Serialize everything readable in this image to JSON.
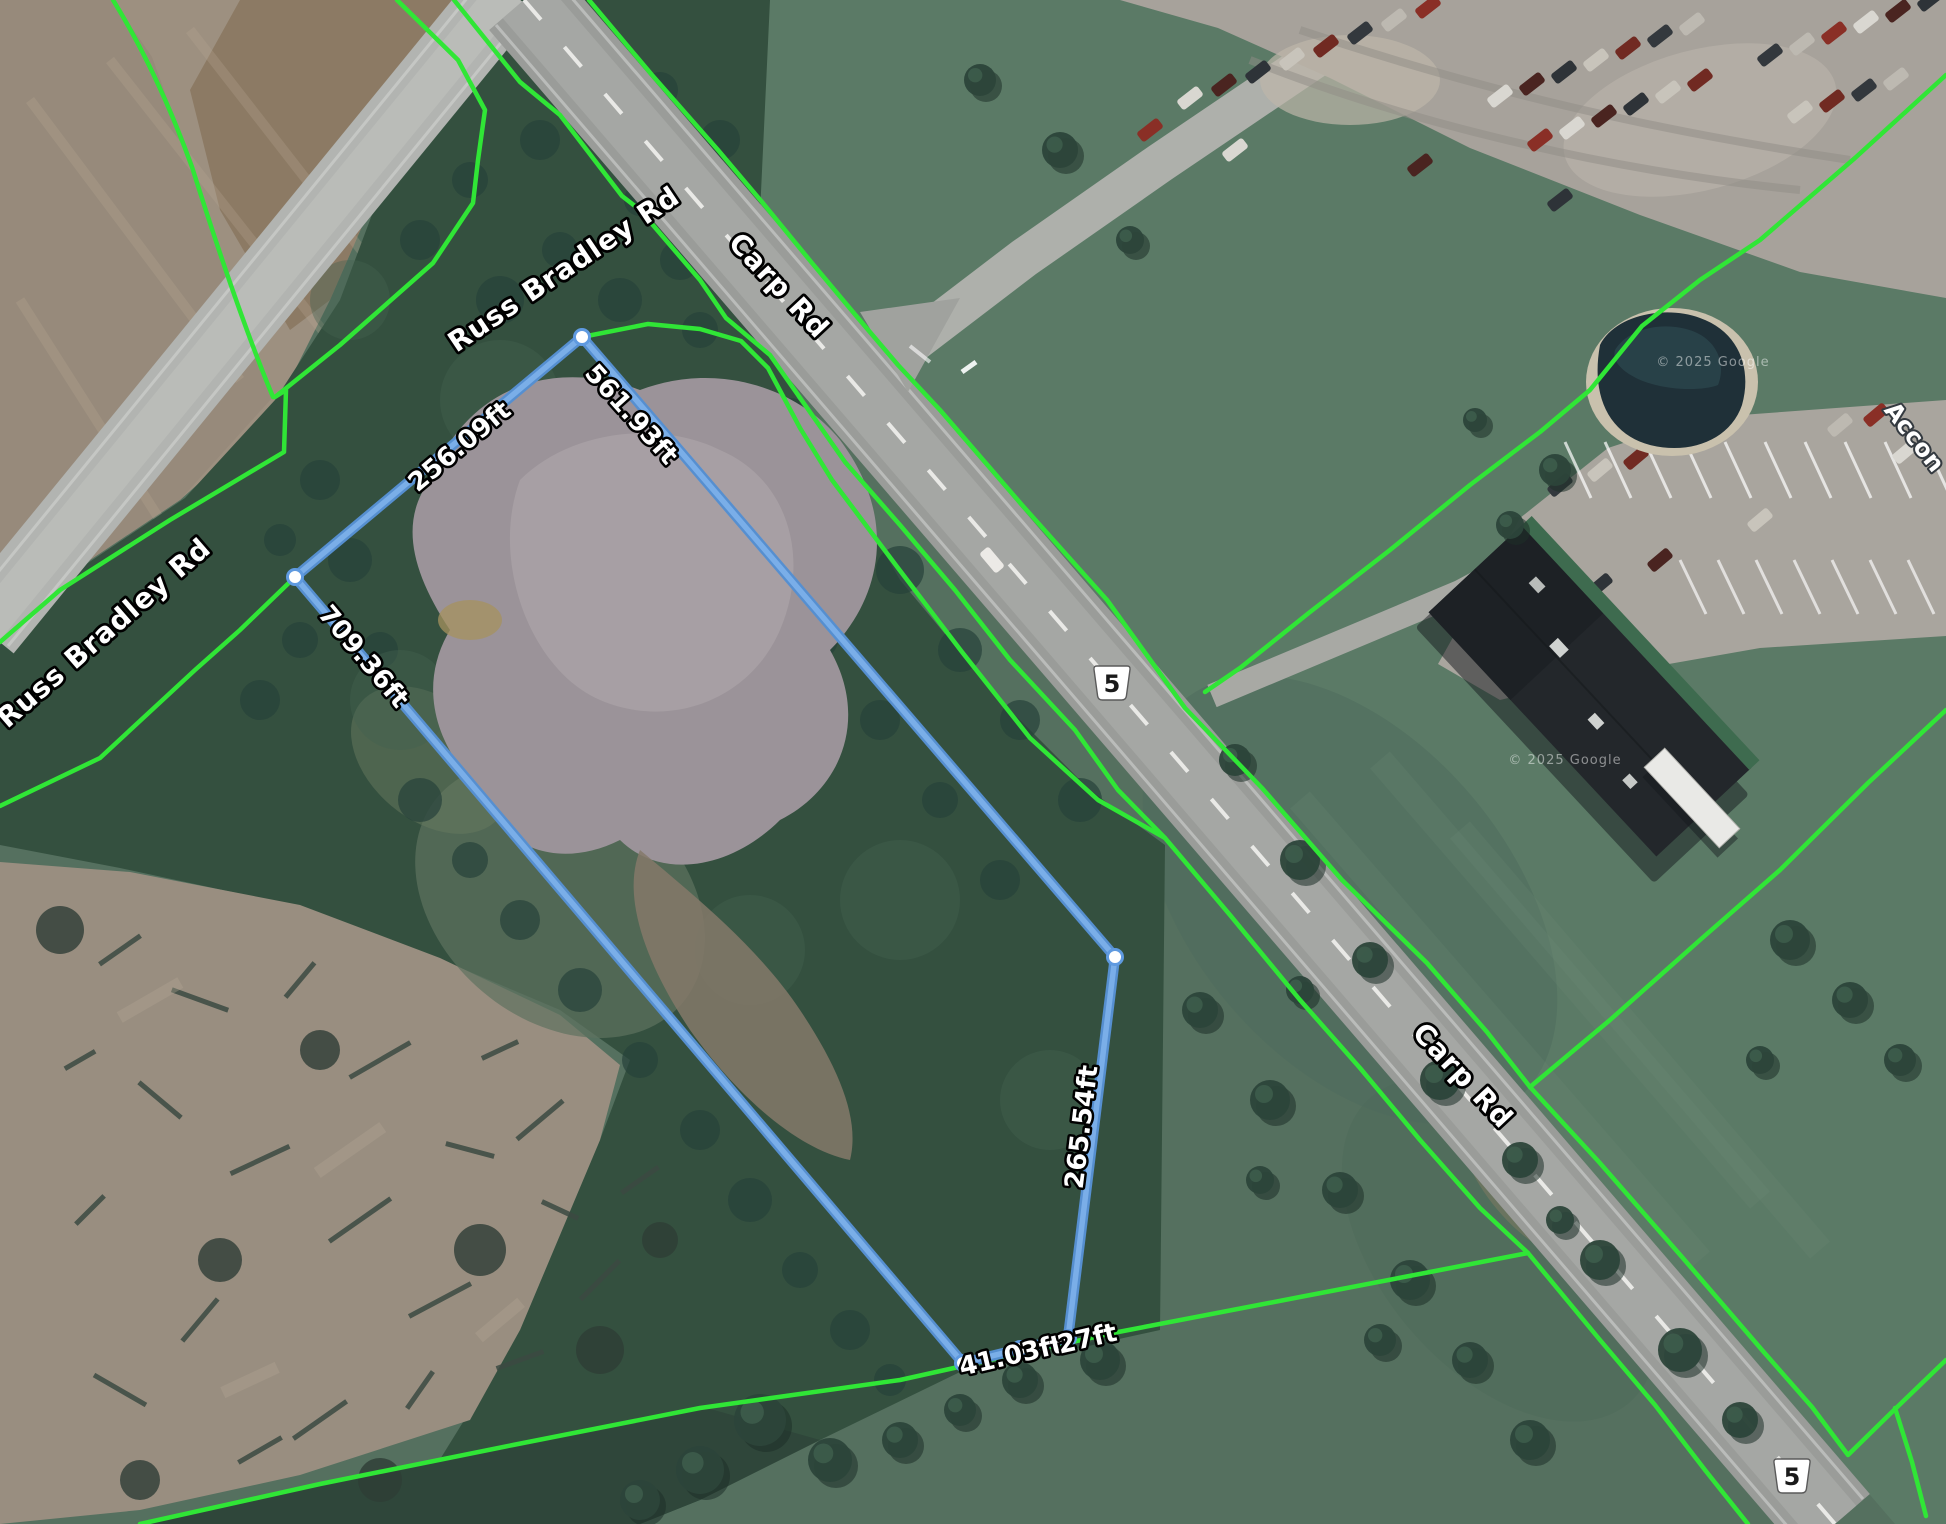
{
  "map_overlay": {
    "road_labels": {
      "russ_bradley": "Russ Bradley Rd",
      "carp": "Carp Rd"
    },
    "route_shield": {
      "number": "5"
    },
    "measurements": {
      "north": "256.09ft",
      "northeast": "561.93ft",
      "southwest": "709.36ft",
      "east": "265.54ft",
      "south_a": "41.03ft",
      "south_b": "27ft"
    },
    "place_label": "Accon",
    "attribution": "© 2025 Google",
    "colors": {
      "measure_line": "#568fd0",
      "measure_line_light": "#7aaee8",
      "parcel_line": "#30e636",
      "vertex": "#ffffff"
    }
  }
}
